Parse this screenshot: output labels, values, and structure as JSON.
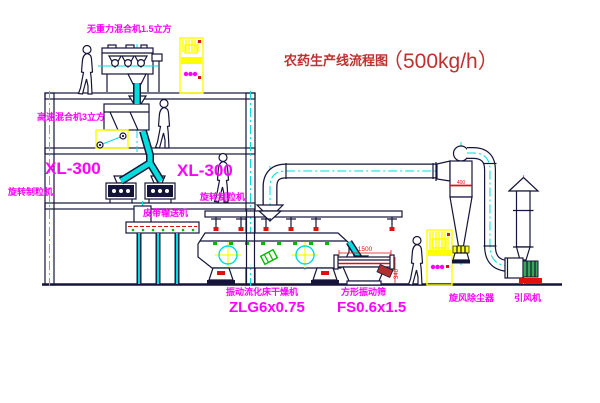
{
  "colors": {
    "line": "#15153A",
    "cyan": "#00DDDD",
    "magenta": "#FF00FF",
    "yellow": "#FFFF00",
    "red": "#E01010",
    "title_red": "#C03030",
    "green": "#00BB00",
    "motor_green": "#3AA65A"
  },
  "title": {
    "name": "农药生产线流程图",
    "capacity": "（500kg/h）"
  },
  "labels": {
    "gravity_mixer": "无重力混合机1.5立方",
    "high_speed_mixer": "高速混合机3立方",
    "granulator_left_model": "XL-300",
    "granulator_left_name": "旋转制粒机",
    "granulator_mid_model": "XL-300",
    "granulator_mid_name": "旋转制粒机",
    "belt_conveyor": "皮带输送机",
    "dryer_name": "振动流化床干燥机",
    "dryer_model": "ZLG6x0.75",
    "sieve_name": "方形振动筛",
    "sieve_model": "FS0.6x1.5",
    "cyclone_name": "旋风除尘器",
    "fan_name": "引风机"
  },
  "dimensions": {
    "sieve_length": "1500",
    "sieve_height": "340",
    "cyclone_dia": "400"
  }
}
